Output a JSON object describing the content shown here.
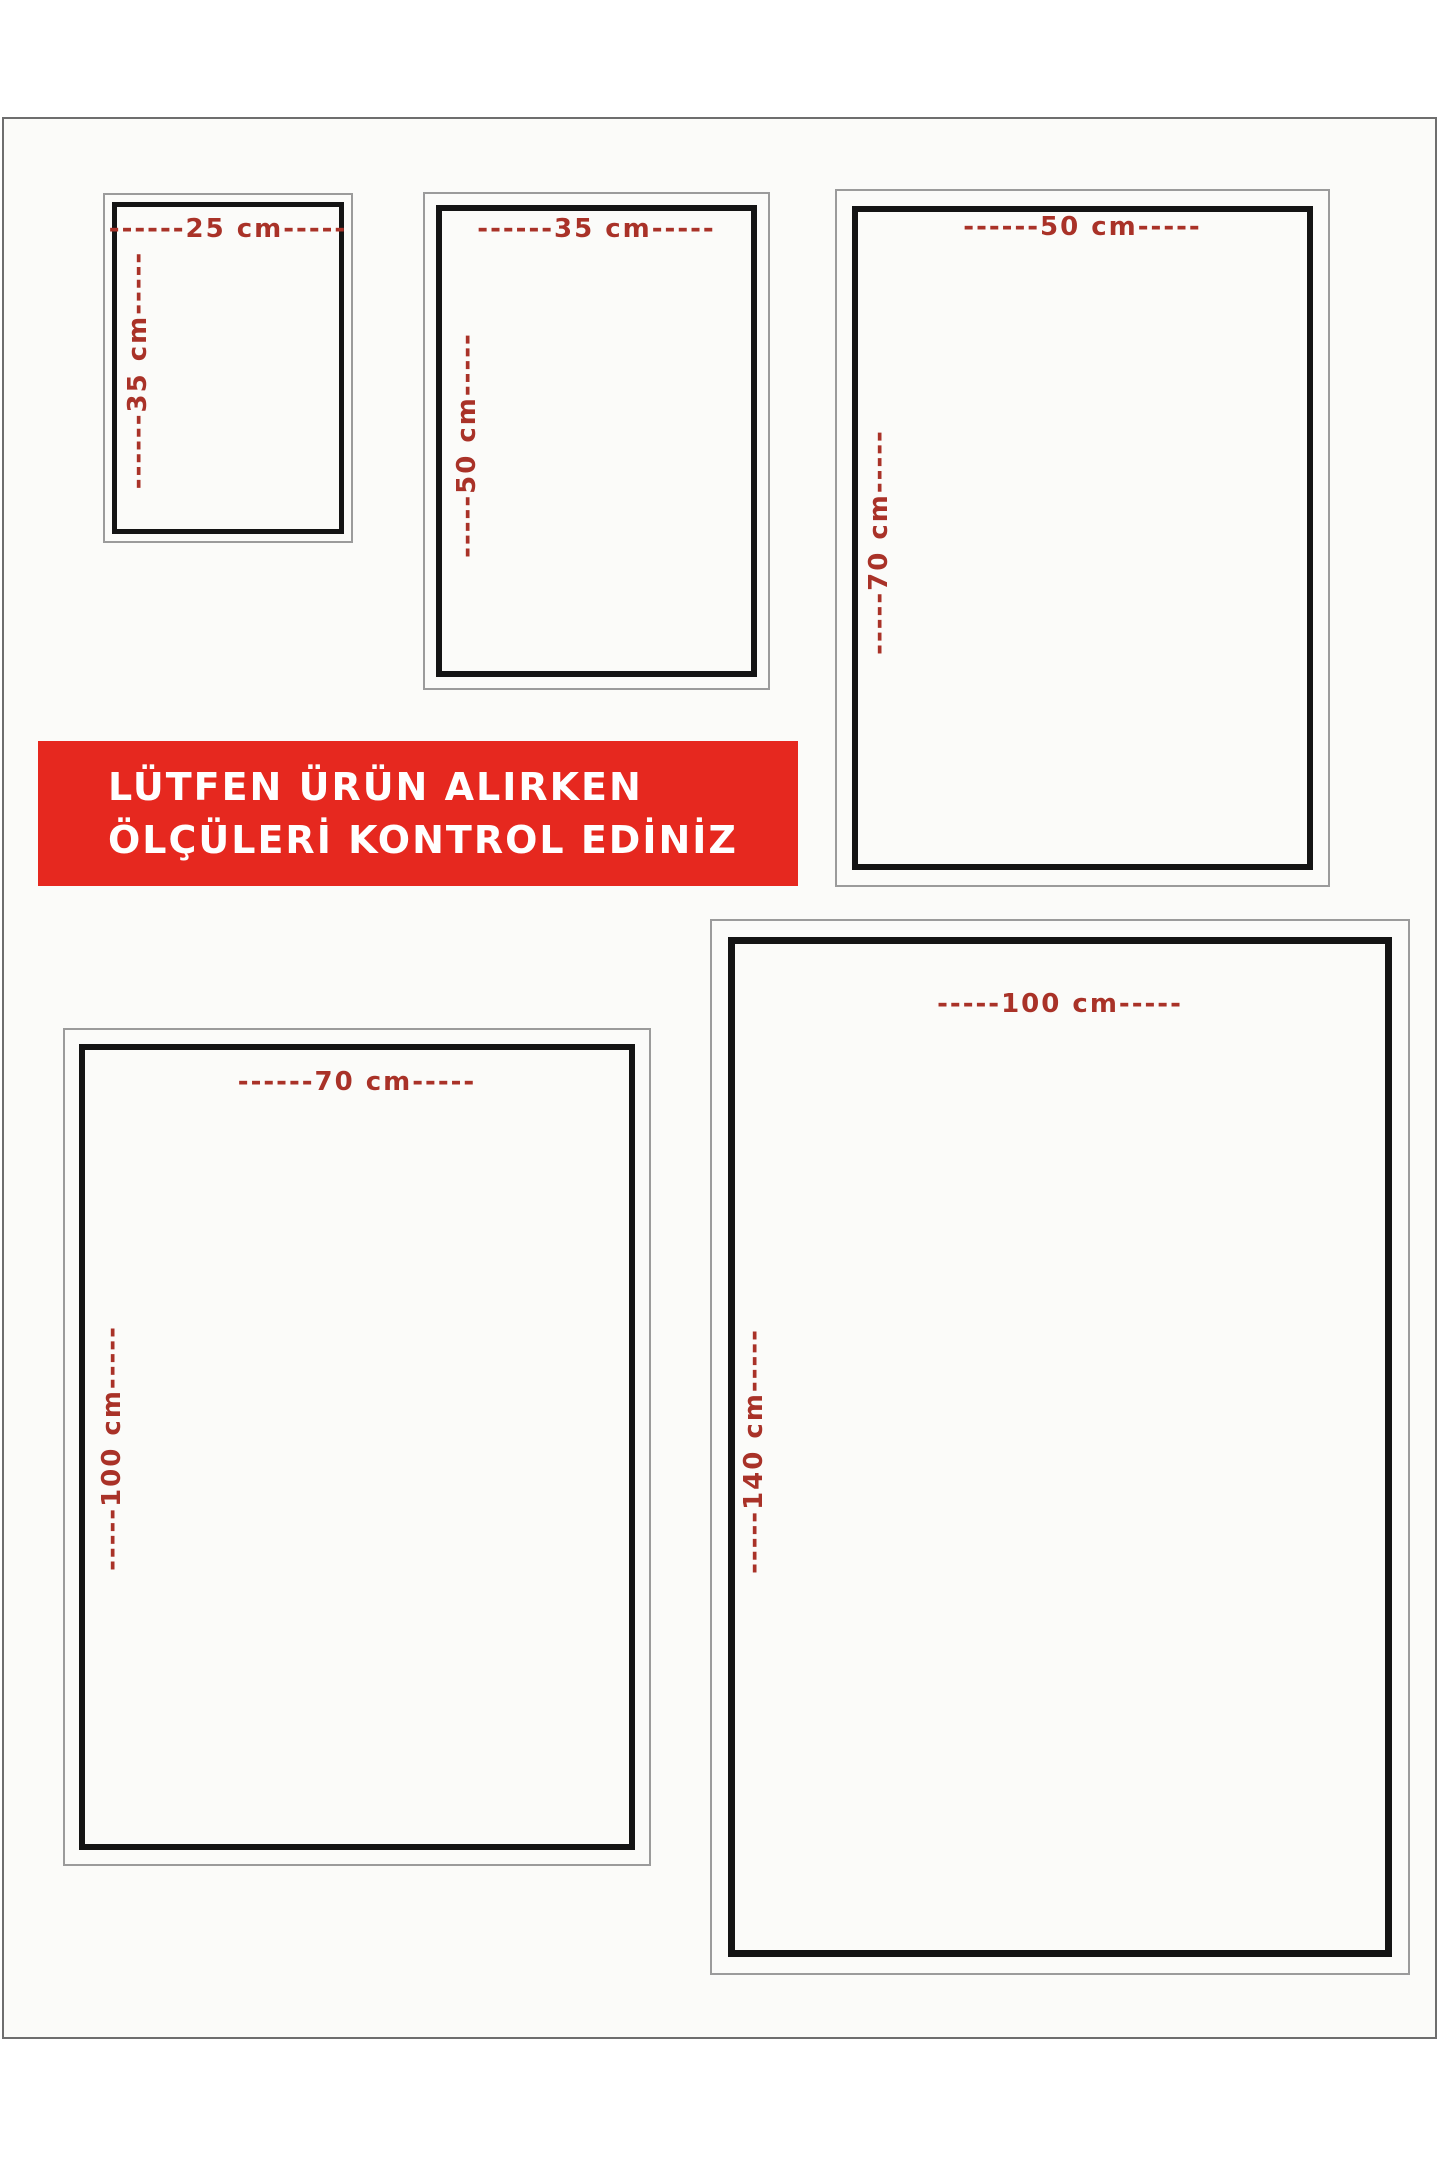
{
  "banner": {
    "line1": "LÜTFEN ÜRÜN ALIRKEN",
    "line2": "ÖLÇÜLERİ KONTROL EDİNİZ",
    "bg_color": "#e6281f",
    "text_color": "#ffffff"
  },
  "label_color": "#a93228",
  "sizes": [
    {
      "name": "25x35 cm",
      "width_cm": "25 cm",
      "height_cm": "35 cm",
      "top_label": "------25 cm-----",
      "side_label": "------35 cm-----"
    },
    {
      "name": "35x50 cm",
      "width_cm": "35 cm",
      "height_cm": "50 cm",
      "top_label": "------35 cm-----",
      "side_label": "-----50 cm-----"
    },
    {
      "name": "50x70 cm",
      "width_cm": "50 cm",
      "height_cm": "70 cm",
      "top_label": "------50 cm-----",
      "side_label": "-----70 cm-----"
    },
    {
      "name": "70x100 cm",
      "width_cm": "70 cm",
      "height_cm": "100 cm",
      "top_label": "------70 cm-----",
      "side_label": "-----100 cm-----"
    },
    {
      "name": "100x140 cm",
      "width_cm": "100 cm",
      "height_cm": "140 cm",
      "top_label": "-----100 cm-----",
      "side_label": "-----140 cm-----"
    }
  ]
}
